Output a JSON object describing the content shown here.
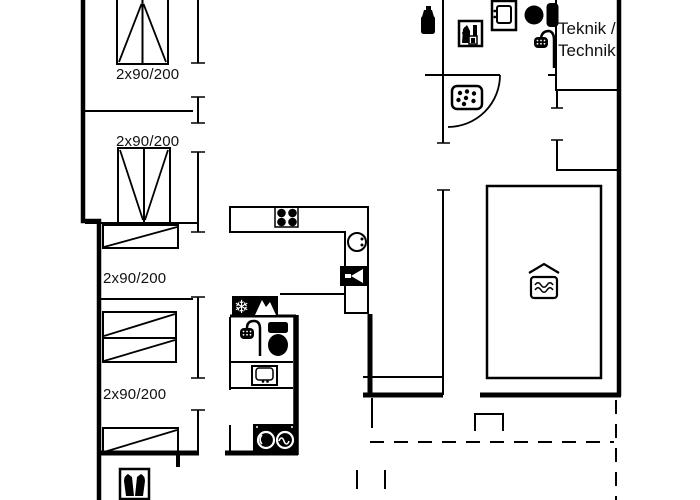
{
  "plan": {
    "type": "holiday-house-floor-plan",
    "background": "#ffffff",
    "line_color": "#000000",
    "text_color": "#111111"
  },
  "labels": {
    "bed1": "2x90/200",
    "bed2": "2x90/200",
    "bed3": "2x90/200",
    "bed4": "2x90/200",
    "teknik_line1": "Teknik /",
    "teknik_line2": "Technik"
  },
  "icons": {
    "names": [
      "bottle-icon",
      "utility-cabinet-icon",
      "washbasin-icon",
      "toilet-icon",
      "shower-icon",
      "whirlpool-icon",
      "stove-burners-icon",
      "kitchen-sink-icon",
      "fireplace-icon",
      "freezer-icon",
      "oven-icon",
      "washing-machine-icon",
      "dryer-icon",
      "swimming-pool",
      "pool-water-icon",
      "double-bed-icon",
      "bunk-bed-icon",
      "boots-icon"
    ]
  }
}
